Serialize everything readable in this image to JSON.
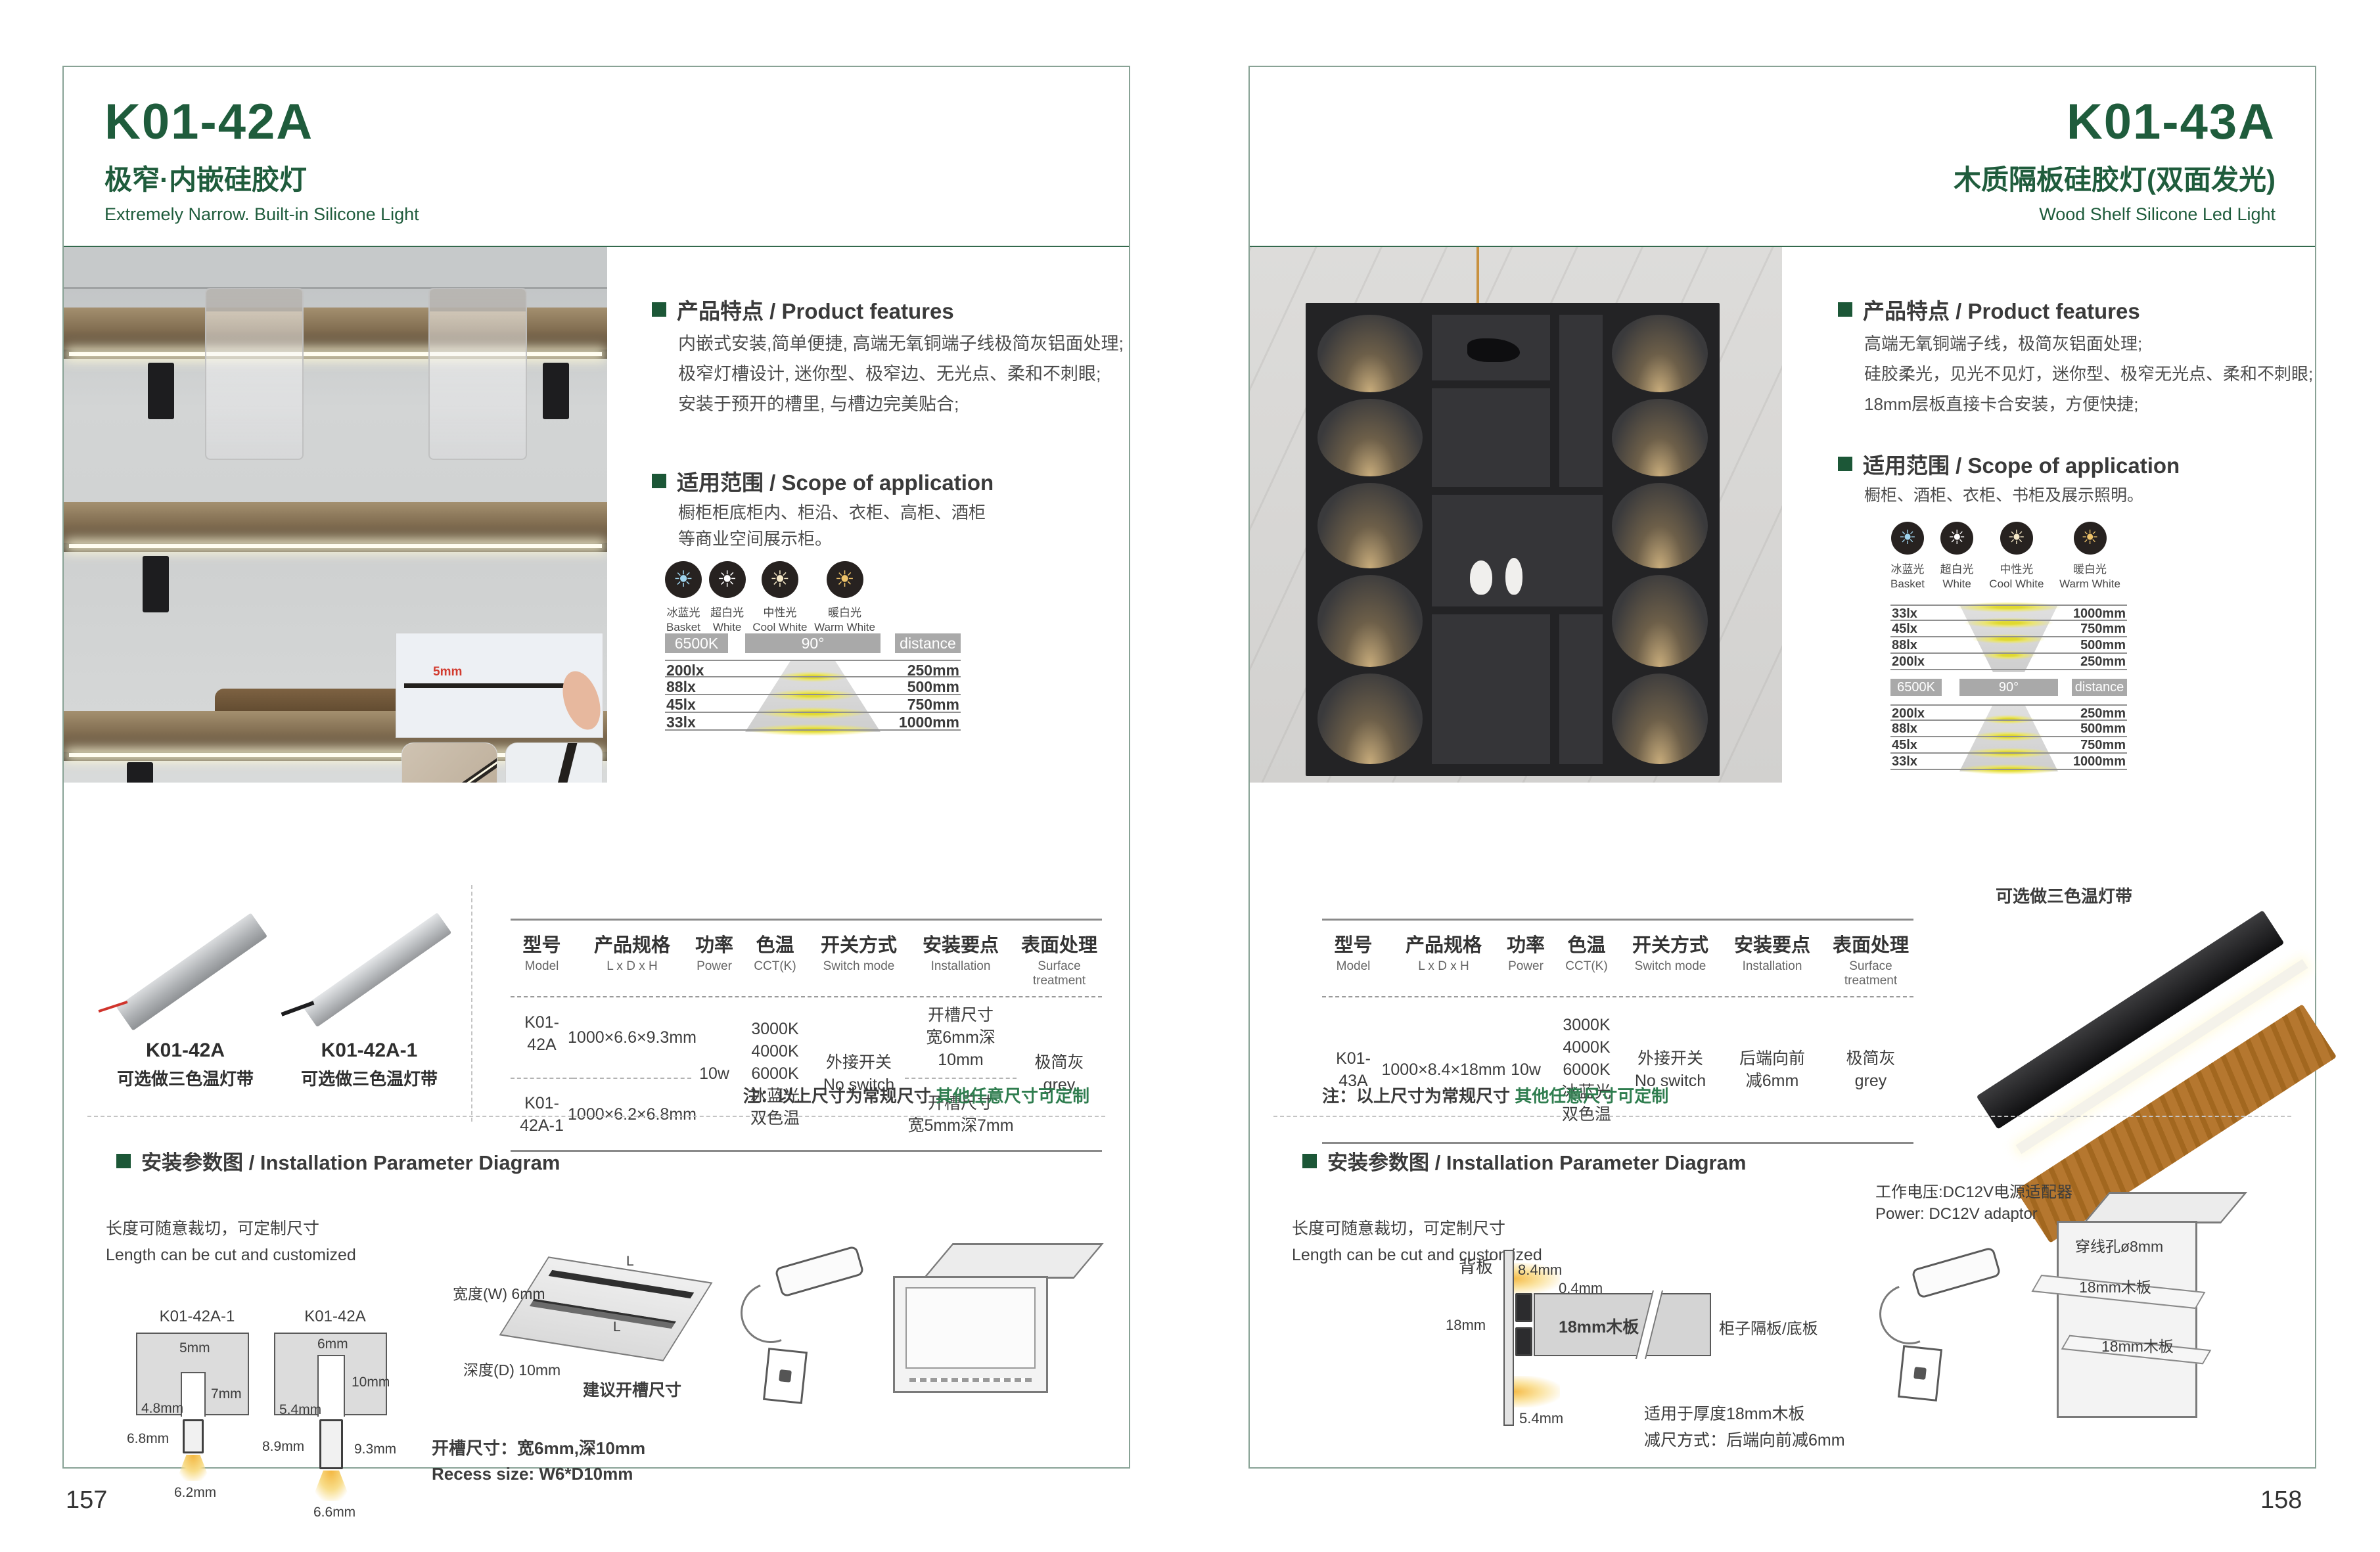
{
  "accent_green": "#1f5c3c",
  "page_left": {
    "page_no": "157",
    "model": "K01-42A",
    "title_cn": "极窄·内嵌硅胶灯",
    "title_en": "Extremely Narrow. Built-in Silicone Light",
    "features_title": "产品特点 / Product features",
    "features": [
      "内嵌式安装,简单便捷, 高端无氧铜端子线极简灰铝面处理;",
      "极窄灯槽设计, 迷你型、极窄边、无光点、柔和不刺眼;",
      "安装于预开的槽里, 与槽边完美贴合;"
    ],
    "scope_title": "适用范围 / Scope of application",
    "scope": [
      "橱柜柜底柜内、柜沿、衣柜、高柜、酒柜",
      "等商业空间展示柜。"
    ],
    "inset_dim": "5mm",
    "icons": [
      {
        "cn": "冰蓝光",
        "en": "Basket",
        "color": "#9fd4ee"
      },
      {
        "cn": "超白光",
        "en": "White",
        "color": "#ffffff"
      },
      {
        "cn": "中性光",
        "en": "Cool White",
        "color": "#f6e9c8"
      },
      {
        "cn": "暖白光",
        "en": "Warm White",
        "color": "#eec36a"
      }
    ],
    "chart": {
      "cct": "6500K",
      "angle": "90°",
      "distance_label": "distance",
      "rows": [
        {
          "lux": "200lx",
          "mm": "250mm"
        },
        {
          "lux": "88lx",
          "mm": "500mm"
        },
        {
          "lux": "45lx",
          "mm": "750mm"
        },
        {
          "lux": "33lx",
          "mm": "1000mm"
        }
      ]
    },
    "products": [
      {
        "model": "K01-42A",
        "caption": "可选做三色温灯带"
      },
      {
        "model": "K01-42A-1",
        "caption": "可选做三色温灯带"
      }
    ],
    "table": {
      "headers": [
        {
          "cn": "型号",
          "en": "Model"
        },
        {
          "cn": "产品规格",
          "en": "L x D x H"
        },
        {
          "cn": "功率",
          "en": "Power"
        },
        {
          "cn": "色温",
          "en": "CCT(K)"
        },
        {
          "cn": "开关方式",
          "en": "Switch mode"
        },
        {
          "cn": "安装要点",
          "en": "Installation"
        },
        {
          "cn": "表面处理",
          "en": "Surface treatment"
        }
      ],
      "row1": {
        "model": "K01-42A",
        "size": "1000×6.6×9.3mm",
        "install1": "开槽尺寸",
        "install2": "宽6mm深10mm"
      },
      "row2": {
        "model": "K01-42A-1",
        "size": "1000×6.2×6.8mm",
        "install1": "开槽尺寸",
        "install2": "宽5mm深7mm"
      },
      "power": "10w",
      "cct": [
        "3000K",
        "4000K",
        "6000K",
        "冰蓝光",
        "双色温"
      ],
      "switch1": "外接开关",
      "switch2": "No switch",
      "surface1": "极简灰",
      "surface2": "grey"
    },
    "note_prefix": "注：以上尺寸为常规尺寸 ",
    "note_green": "其他任意尺寸可定制",
    "install": {
      "title": "安装参数图 / Installation Parameter Diagram",
      "cut_cn": "长度可随意裁切，可定制尺寸",
      "cut_en": "Length can be cut and customized",
      "d1": {
        "label": "K01-42A-1",
        "top": "5mm",
        "depth": "7mm",
        "inner": "4.8mm",
        "left": "6.8mm",
        "bottom": "6.2mm"
      },
      "d2": {
        "label": "K01-42A",
        "top": "6mm",
        "depth": "10mm",
        "inner": "5.4mm",
        "left": "8.9mm",
        "right": "9.3mm",
        "bottom": "6.6mm"
      },
      "board": {
        "w": "宽度(W) 6mm",
        "d": "深度(D) 10mm",
        "suggest": "建议开槽尺寸",
        "l1": "L",
        "l2": "L"
      },
      "recess_cn": "开槽尺寸：宽6mm,深10mm",
      "recess_en": "Recess size: W6*D10mm"
    }
  },
  "page_right": {
    "page_no": "158",
    "model": "K01-43A",
    "title_cn": "木质隔板硅胶灯(双面发光)",
    "title_en": "Wood Shelf Silicone Led Light",
    "features_title": "产品特点 / Product features",
    "features": [
      "高端无氧铜端子线，极简灰铝面处理;",
      "硅胶柔光，见光不见灯，迷你型、极窄无光点、柔和不刺眼;",
      "18mm层板直接卡合安装，方便快捷;"
    ],
    "scope_title": "适用范围 / Scope of application",
    "scope": [
      "橱柜、酒柜、衣柜、书柜及展示照明。"
    ],
    "icons": [
      {
        "cn": "冰蓝光",
        "en": "Basket",
        "color": "#9fd4ee"
      },
      {
        "cn": "超白光",
        "en": "White",
        "color": "#ffffff"
      },
      {
        "cn": "中性光",
        "en": "Cool White",
        "color": "#f6e9c8"
      },
      {
        "cn": "暖白光",
        "en": "Warm White",
        "color": "#eec36a"
      }
    ],
    "chart": {
      "cct": "6500K",
      "angle": "90°",
      "distance_label": "distance",
      "rows_top": [
        {
          "lux": "33lx",
          "mm": "1000mm"
        },
        {
          "lux": "45lx",
          "mm": "750mm"
        },
        {
          "lux": "88lx",
          "mm": "500mm"
        },
        {
          "lux": "200lx",
          "mm": "250mm"
        }
      ],
      "rows_bottom": [
        {
          "lux": "200lx",
          "mm": "250mm"
        },
        {
          "lux": "88lx",
          "mm": "500mm"
        },
        {
          "lux": "45lx",
          "mm": "750mm"
        },
        {
          "lux": "33lx",
          "mm": "1000mm"
        }
      ]
    },
    "product_caption": "可选做三色温灯带",
    "table": {
      "headers": [
        {
          "cn": "型号",
          "en": "Model"
        },
        {
          "cn": "产品规格",
          "en": "L x D x H"
        },
        {
          "cn": "功率",
          "en": "Power"
        },
        {
          "cn": "色温",
          "en": "CCT(K)"
        },
        {
          "cn": "开关方式",
          "en": "Switch mode"
        },
        {
          "cn": "安装要点",
          "en": "Installation"
        },
        {
          "cn": "表面处理",
          "en": "Surface treatment"
        }
      ],
      "row": {
        "model": "K01-43A",
        "size": "1000×8.4×18mm",
        "power": "10w",
        "switch1": "外接开关",
        "switch2": "No switch",
        "install1": "后端向前",
        "install2": "减6mm",
        "surface1": "极简灰",
        "surface2": "grey"
      },
      "cct": [
        "3000K",
        "4000K",
        "6000K",
        "冰蓝光",
        "双色温"
      ]
    },
    "note_prefix": "注：以上尺寸为常规尺寸 ",
    "note_green": "其他任意尺寸可定制",
    "install": {
      "title": "安装参数图 / Installation Parameter Diagram",
      "cut_cn": "长度可随意裁切，可定制尺寸",
      "cut_en": "Length can be cut and customized",
      "back_label": "背板",
      "dim_a": "8.4mm",
      "dim_b": "0.4mm",
      "dim_c": "18mm",
      "dim_d": "5.4mm",
      "board_label": "18mm木板",
      "side_label": "柜子隔板/底板",
      "fit_note1": "适用于厚度18mm木板",
      "fit_note2": "减尺方式：后端向前减6mm",
      "power_cn": "工作电压:DC12V电源适配器",
      "power_en": "Power: DC12V adaptor",
      "hole": "穿线孔ø8mm",
      "shelf1": "18mm木板",
      "shelf2": "18mm木板"
    }
  }
}
